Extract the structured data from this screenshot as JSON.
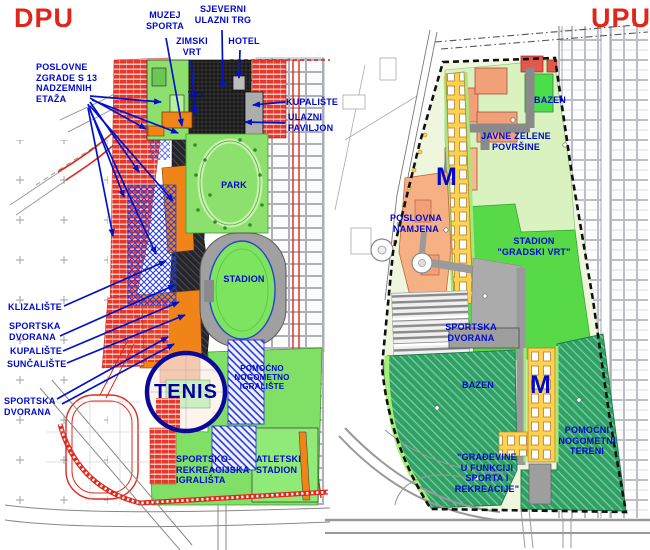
{
  "colors": {
    "title_red": "#e1251b",
    "label_blue": "#0009cc",
    "park_green": "#8ee06e",
    "stadium_green": "#57d948",
    "pale_green": "#d9f2bf",
    "teal_green": "#2fa066",
    "orange": "#f08418",
    "map_red": "#e8382a",
    "yellow": "#ffd24d",
    "navy_circle": "#0a0a99"
  },
  "left_map": {
    "title": "DPU",
    "annotations": {
      "muzej_sporta": "MUZEJ\nSPORTA",
      "sjeverni_ulazni_trg": "SJEVERNI\nULAZNI TRG",
      "zimski_vrt": "ZIMSKI\nVRT",
      "hotel": "HOTEL",
      "poslovne_zgrade": "POSLOVNE\nZGRADE S 13\nNADZEMNIH\nETAŽA",
      "kupaliste_desno": "KUPALIŠTE",
      "ulazni_paviljon": "ULAZNI\nPAVILJON",
      "klizaliste": "KLIZALIŠTE",
      "sportska_dvorana_1": "SPORTSKA\nDVORANA",
      "kupaliste_lijevo": "KUPALIŠTE",
      "suncaliste": "SUNČALIŠTE",
      "sportska_dvorana_2": "SPORTSKA\nDVORANA"
    },
    "area_labels": {
      "vrt": "VRT",
      "park": "PARK",
      "stadion": "STADION",
      "tenis": "TENIS",
      "pomocno_nogometno": "POMOĆNO\nNOGOMETNO\nIGRALIŠTE",
      "sportsko_rekreacijska": "SPORTSKO-\nREKREACIJSKA\nIGRALIŠTA",
      "atletski_stadion": "ATLETSKI\nSTADION"
    }
  },
  "right_map": {
    "title": "UPU",
    "area_labels": {
      "bazen_top": "BAZEN",
      "javne_zelene": "JAVNE ZELENE\nPOVRŠINE",
      "m_top": "M",
      "poslovna_namjena": "POSLOVNA\nNAMJENA",
      "stadion_gradski_vrt": "STADION\n\"GRADSKI VRT\"",
      "sportska_dvorana": "SPORTSKA\nDVORANA",
      "bazen_bottom": "BAZEN",
      "m_bottom": "M",
      "pomocni_nogometni": "POMOĆNI\nNOGOMETNI\nTERENI",
      "gradevine": "\"GRAĐEVINE\nU FUNKCIJI\nSPORTA I\nREKREACIJE\""
    }
  }
}
